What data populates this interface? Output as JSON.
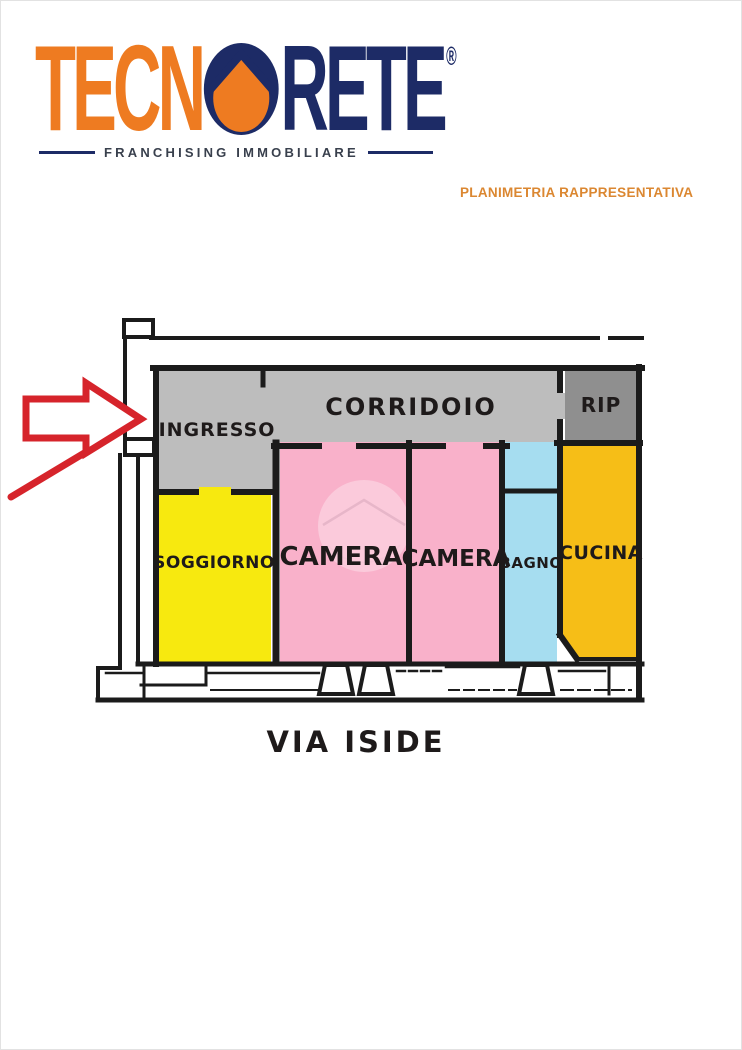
{
  "header": {
    "logo": {
      "part1": "TECN",
      "part2": "RETE",
      "registered": "®",
      "tagline": "FRANCHISING IMMOBILIARE",
      "orange": "#ee7b21",
      "navy": "#1d2b66"
    },
    "subtitle": "PLANIMETRIA RAPPRESENTATIVA",
    "subtitle_color": "#db8731"
  },
  "plan": {
    "street_label": "VIA ISIDE",
    "rooms": {
      "ingresso": {
        "label": "INGRESSO",
        "color": "#bdbdbd"
      },
      "corridoio": {
        "label": "CORRIDOIO",
        "color": "#bdbdbd"
      },
      "rip": {
        "label": "RIP",
        "color": "#8f8f8f"
      },
      "soggiorno": {
        "label": "SOGGIORNO",
        "color": "#f7e90f"
      },
      "camera1": {
        "label": "CAMERA",
        "color": "#f9b1ca"
      },
      "camera2": {
        "label": "CAMERA",
        "color": "#f9b1ca"
      },
      "bagno": {
        "label": "BAGNO",
        "color": "#a6ddf0"
      },
      "cucina": {
        "label": "CUCINA",
        "color": "#f6be17"
      }
    },
    "colors": {
      "wall": "#1b1b1b",
      "arrow": "#d6242b",
      "label_text": "#1e1a1a",
      "watermark": "#ffffff"
    }
  }
}
